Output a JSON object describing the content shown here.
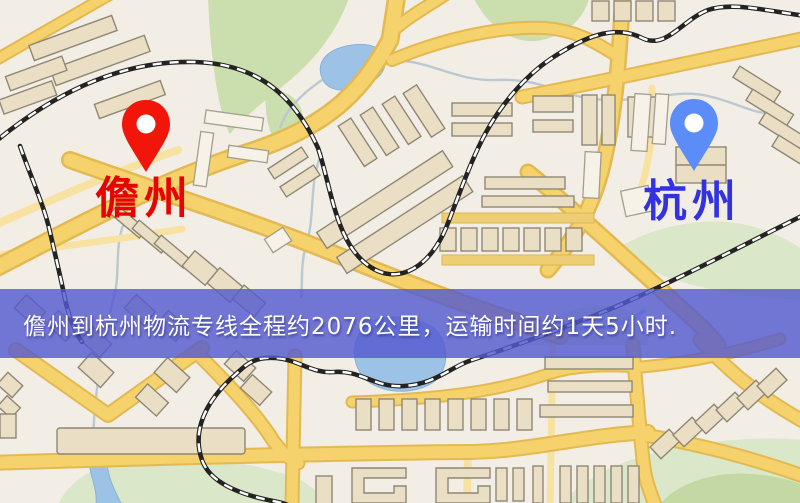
{
  "map": {
    "banner": {
      "text": "儋州到杭州物流专线全程约2076公里，运输时间约1天5小时.",
      "background_color": "#545ad0",
      "text_color": "#ffffff"
    },
    "markers": [
      {
        "id": "origin",
        "label": "儋州",
        "pin_color": "#f2150a",
        "pin_hole_color": "#ffffff",
        "label_color": "#e60400"
      },
      {
        "id": "destination",
        "label": "杭州",
        "pin_color": "#5b8cf8",
        "pin_hole_color": "#ffffff",
        "label_color": "#3232e0"
      }
    ],
    "palette": {
      "land": "#f2eee6",
      "road_fill": "#f6d26c",
      "road_casing": "#e3b951",
      "road_minor": "#f8e2a2",
      "park": "#cbdead",
      "water": "#9cc2e5",
      "railway": "#232323",
      "building": "#eadfc4"
    }
  }
}
